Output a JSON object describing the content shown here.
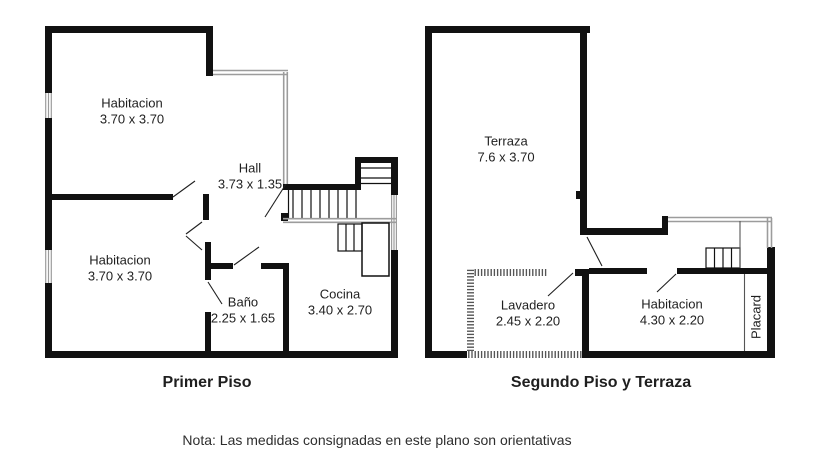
{
  "note": {
    "text": "Nota: Las medidas consignadas en este plano son orientativas"
  },
  "plans": [
    {
      "title": "Primer Piso",
      "rooms": [
        {
          "name": "Habitacion",
          "dims": "3.70 x 3.70"
        },
        {
          "name": "Hall",
          "dims": "3.73 x 1.35"
        },
        {
          "name": "Habitacion",
          "dims": "3.70 x 3.70"
        },
        {
          "name": "Baño",
          "dims": "2.25 x 1.65"
        },
        {
          "name": "Cocina",
          "dims": "3.40 x 2.70"
        }
      ]
    },
    {
      "title": "Segundo Piso y Terraza",
      "rooms": [
        {
          "name": "Terraza",
          "dims": "7.6 x 3.70"
        },
        {
          "name": "Lavadero",
          "dims": "2.45 x 2.20"
        },
        {
          "name": "Habitacion",
          "dims": "4.30 x 2.20"
        },
        {
          "name": "Placard",
          "dims": ""
        }
      ]
    }
  ],
  "colors": {
    "wall": "#111111",
    "railing": "#9c9c9c",
    "hatch": "#4d4d4d",
    "text": "#1f1f1f",
    "note": "#2e2e2e"
  }
}
